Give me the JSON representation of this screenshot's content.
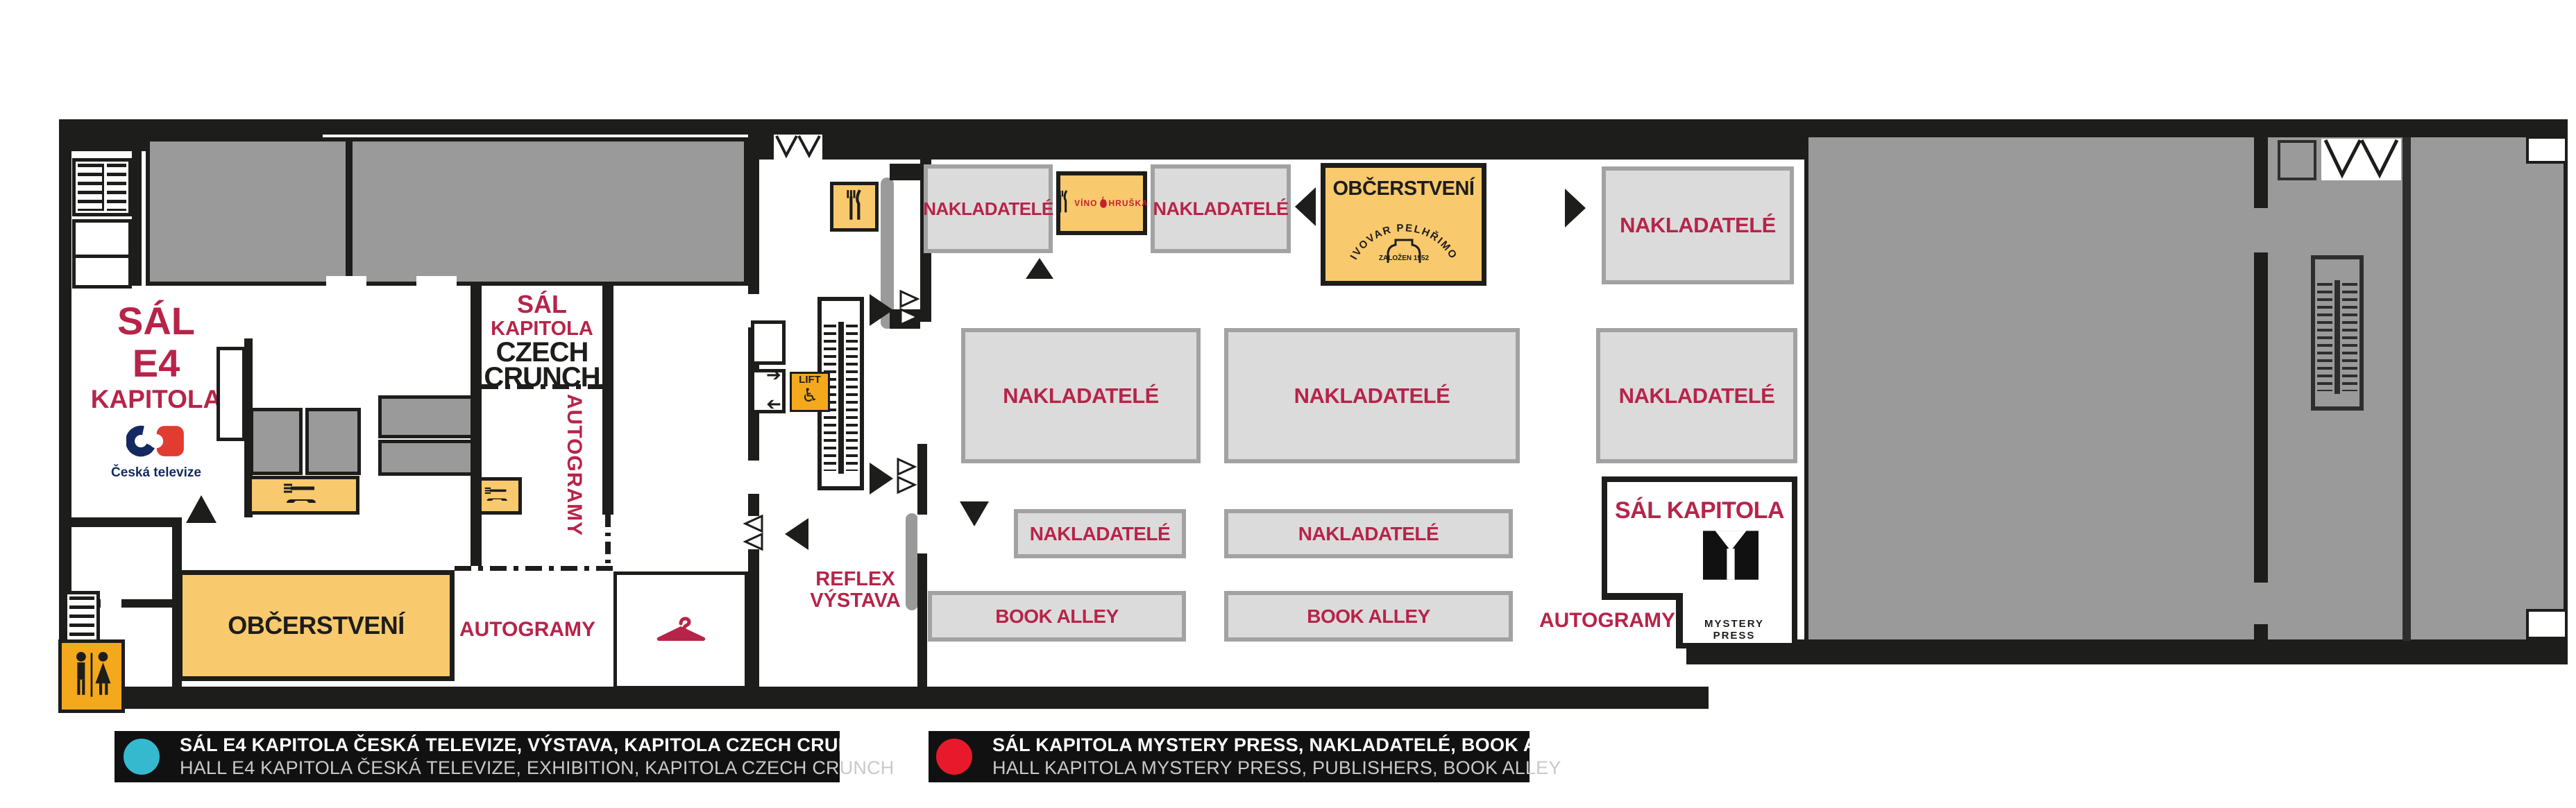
{
  "colors": {
    "wall_black": "#1d1d1b",
    "crimson": "#b72449",
    "area_gray": "#9b9a9a",
    "booth_gray": "#dcdbdb",
    "booth_border": "#a3a2a2",
    "service_yellow": "#f9c96d",
    "accent_yellow": "#f4a91c",
    "legend_cyan": "#35b9cf",
    "legend_red": "#e8192b",
    "ct_navy": "#14295f",
    "ct_red": "#e23b30"
  },
  "hall_e4": {
    "title_line1": "SÁL",
    "title_line2": "E4",
    "title_line3": "KAPITOLA",
    "sponsor": "Česká televize"
  },
  "czech_crunch": {
    "line1": "SÁL",
    "line2": "KAPITOLA",
    "line3": "CZECH",
    "line4": "CRUNCH"
  },
  "zones": {
    "autogramy": "AUTOGRAMY",
    "obcerstveni": "OBČERSTVENÍ",
    "reflex_line1": "REFLEX",
    "reflex_line2": "VÝSTAVA",
    "lift": "LIFT",
    "nakladatele": "NAKLADATELÉ",
    "book_alley": "BOOK ALLEY"
  },
  "mystery_press": {
    "title": "SÁL KAPITOLA",
    "brand": "MYSTERY PRESS"
  },
  "pivovar": {
    "name": "PIVOVAR PELHŘIMOV",
    "founded": "ZALOŽEN 1552"
  },
  "vino_hruska": {
    "word1": "VÍNO",
    "word2": "HRUŠKA"
  },
  "legend": [
    {
      "dot_color": "#35b9cf",
      "line1": "SÁL E4 KAPITOLA ČESKÁ TELEVIZE, VÝSTAVA, KAPITOLA CZECH CRUNCH",
      "line2": "HALL E4 KAPITOLA ČESKÁ TELEVIZE, EXHIBITION, KAPITOLA CZECH CRUNCH"
    },
    {
      "dot_color": "#e8192b",
      "line1": "SÁL KAPITOLA MYSTERY PRESS, NAKLADATELÉ, BOOK ALLEY",
      "line2": "HALL KAPITOLA MYSTERY PRESS, PUBLISHERS, BOOK ALLEY"
    }
  ]
}
